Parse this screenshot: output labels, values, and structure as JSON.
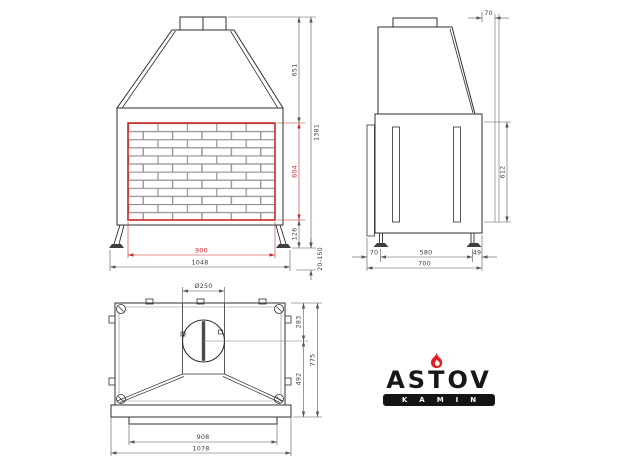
{
  "logo": {
    "brand": "ASTOV",
    "tagline": "KAMIN"
  },
  "views": {
    "front": {
      "dims": {
        "hood_height": "651",
        "opening_height": "604",
        "plinth_height": "126",
        "total_height": "1381",
        "leg_adjust_range": "20-150",
        "opening_width": "900",
        "total_width": "1048"
      }
    },
    "side": {
      "dims": {
        "top_offset": "70",
        "firebox_height": "612",
        "rear_offset": "70",
        "base_depth": "580",
        "front_offset": "49",
        "total_depth": "700"
      }
    },
    "top": {
      "dims": {
        "flue_diameter": "Ø250",
        "flue_center_from_back": "283",
        "flue_center_to_front": "492",
        "total_depth": "775",
        "inner_width": "908",
        "total_width": "1078"
      }
    }
  },
  "colors": {
    "accent_red": "#cc2727",
    "flame_red": "#e31e24",
    "line_dark": "#2f2f2f"
  }
}
